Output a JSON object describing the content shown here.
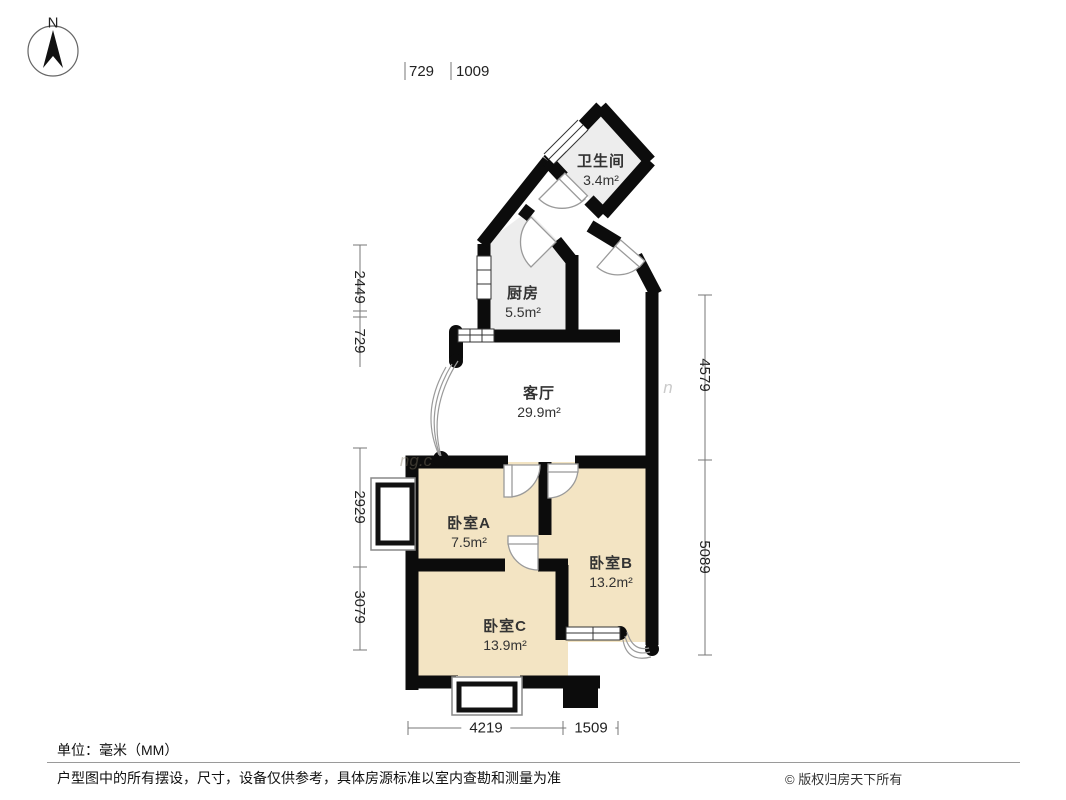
{
  "compass": {
    "north_label": "N"
  },
  "rooms": [
    {
      "key": "bathroom",
      "name": "卫生间",
      "area": "3.4m²"
    },
    {
      "key": "kitchen",
      "name": "厨房",
      "area": "5.5m²"
    },
    {
      "key": "living",
      "name": "客厅",
      "area": "29.9m²"
    },
    {
      "key": "bedroom_a",
      "name": "卧室A",
      "area": "7.5m²"
    },
    {
      "key": "bedroom_b",
      "name": "卧室B",
      "area": "13.2m²"
    },
    {
      "key": "bedroom_c",
      "name": "卧室C",
      "area": "13.9m²"
    }
  ],
  "dimensions_mm": {
    "top": [
      "729",
      "1009"
    ],
    "left": [
      "2449",
      "729",
      "2929",
      "3079"
    ],
    "right": [
      "4579",
      "5089"
    ],
    "bottom": [
      "4219",
      "1509"
    ]
  },
  "watermark_fragments": [
    "ng.c",
    "n"
  ],
  "footer": {
    "unit_note": "单位：毫米（MM）",
    "disclaimer": "户型图中的所有摆设，尺寸，设备仅供参考，具体房源标准以室内查勘和测量为准",
    "copyright": "© 版权归房天下所有"
  },
  "colors": {
    "wall": "#0c0c0c",
    "bedroom_fill": "#f3e4c3",
    "service_fill": "#ededed",
    "dim_line": "#777777",
    "arc_line": "#9a9a9a"
  }
}
